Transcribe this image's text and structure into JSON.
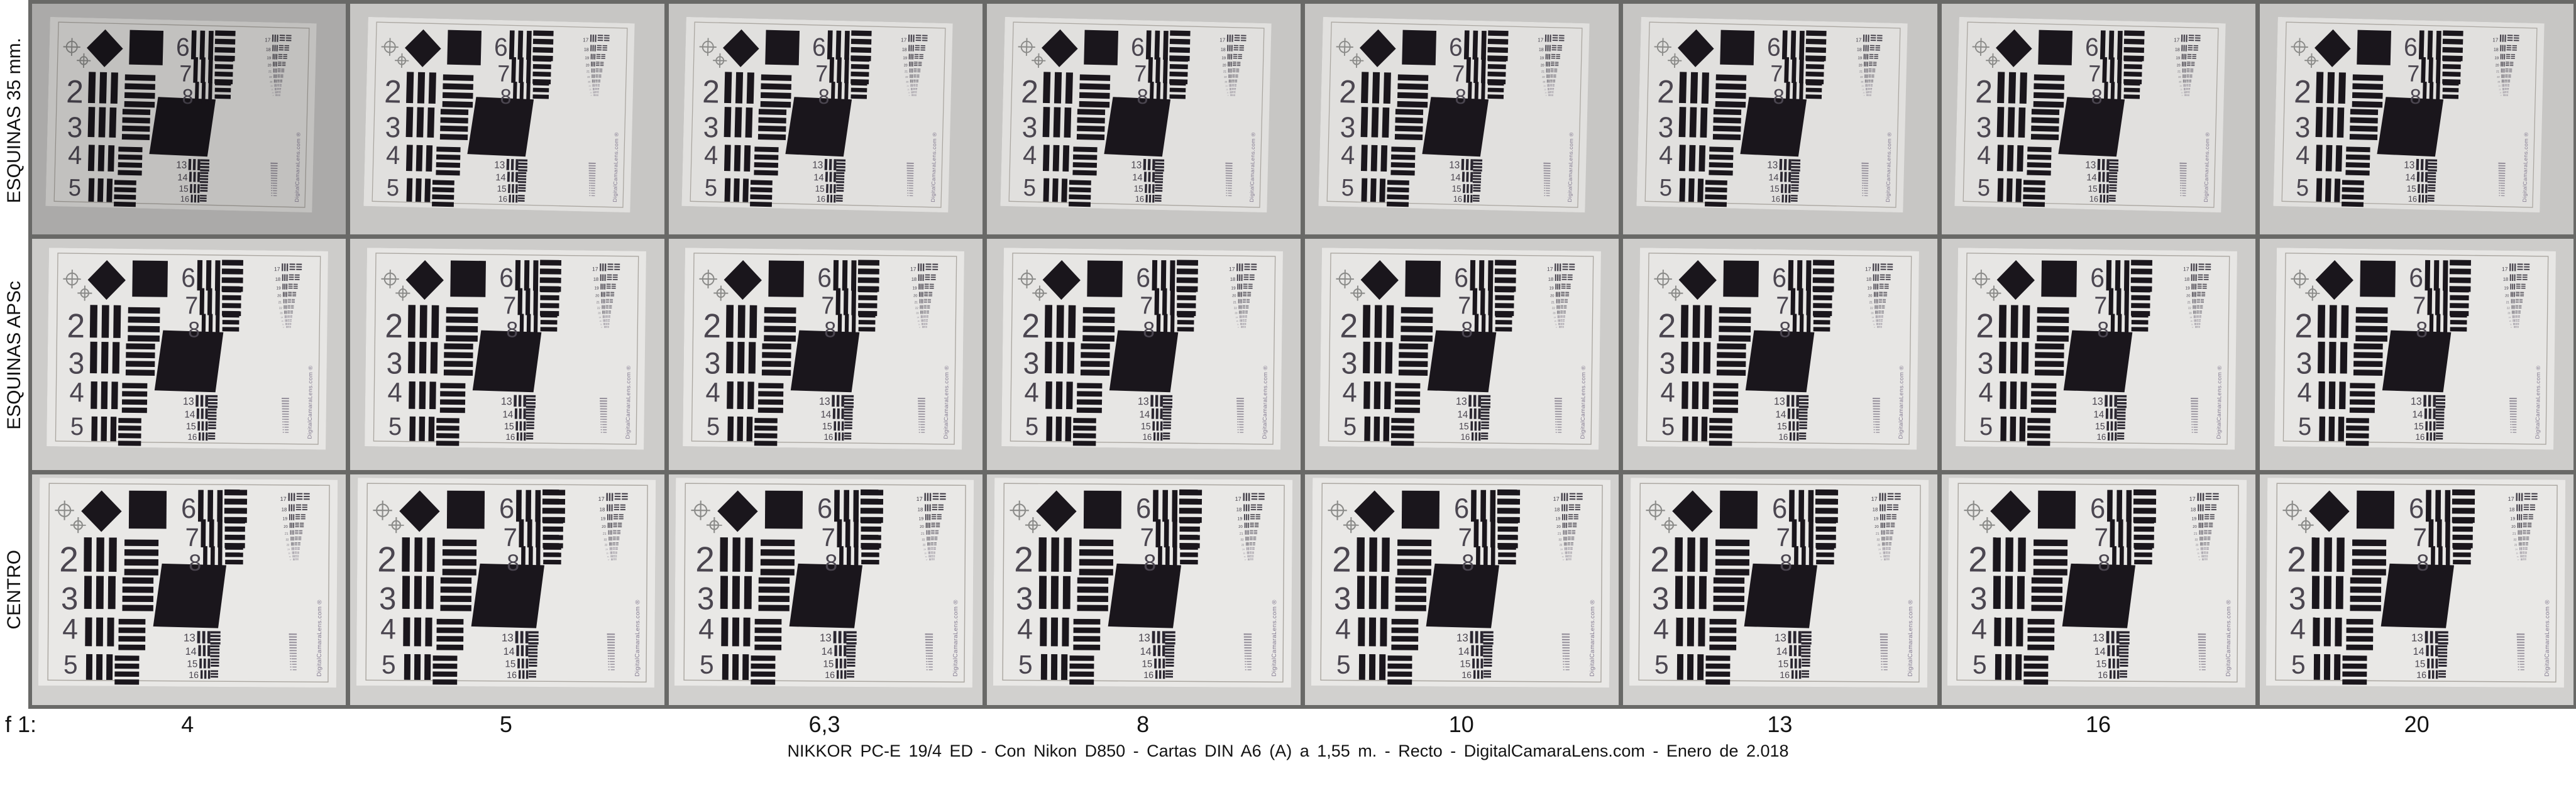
{
  "sheet": {
    "f_prefix": "f 1:",
    "apertures": [
      "4",
      "5",
      "6,3",
      "8",
      "10",
      "13",
      "16",
      "20"
    ],
    "caption": "NIKKOR PC-E  19/4 ED   -   Con Nikon D850   -   Cartas DIN A6 (A) a 1,55 m.   -   Recto   -   DigitalCamaraLens.com   -   Enero de 2.018",
    "grid": {
      "rows": 3,
      "columns": 8
    },
    "rows": [
      {
        "label": "ESQUINAS 35 mm.",
        "slug": "esquinas-35mm",
        "cell_bg": "#c7c6c4",
        "paper": "#e1e0de",
        "left": "5%",
        "top": "7%",
        "width": "85%",
        "height": "82%",
        "rotation": 1.4
      },
      {
        "label": "ESQUINAS APSc",
        "slug": "esquinas-apsc",
        "cell_bg": "#cdccca",
        "paper": "#e7e6e4",
        "left": "5%",
        "top": "4.5%",
        "width": "89%",
        "height": "86%",
        "rotation": 0.7
      },
      {
        "label": "CENTRO",
        "slug": "centro",
        "cell_bg": "#d1d0ce",
        "paper": "#e9e8e6",
        "left": "2.2%",
        "top": "2%",
        "width": "95%",
        "height": "90%",
        "rotation": 0.4
      }
    ],
    "first_cell_brightness": 0.86,
    "colors": {
      "grid_border": "#696967",
      "label_text": "#111111",
      "page_bg": "#ffffff"
    }
  },
  "test_chart": {
    "group_labels_left": [
      "2",
      "3",
      "4",
      "5"
    ],
    "group_labels_mid": [
      "6",
      "7",
      "8"
    ],
    "group_labels_small": [
      "13",
      "14",
      "15",
      "16"
    ],
    "group_labels_right": [
      "17",
      "18",
      "19",
      "20",
      "21",
      "22",
      "23",
      "24",
      "25",
      "26",
      "27"
    ],
    "watermark": "DigitalCamaraLens.com",
    "registered_symbol": "®",
    "colors": {
      "ink": "#1a161c",
      "numeral": "#4b4650",
      "small_ink": "#2a2630",
      "tiny_ink_near": "#46424c",
      "tiny_ink_mid": "#6e6a74",
      "tiny_ink_far": "#948e9a",
      "frame": "#aaa6a0",
      "crosshair": "#8b8b89",
      "watermark_color": "#837a90"
    }
  }
}
